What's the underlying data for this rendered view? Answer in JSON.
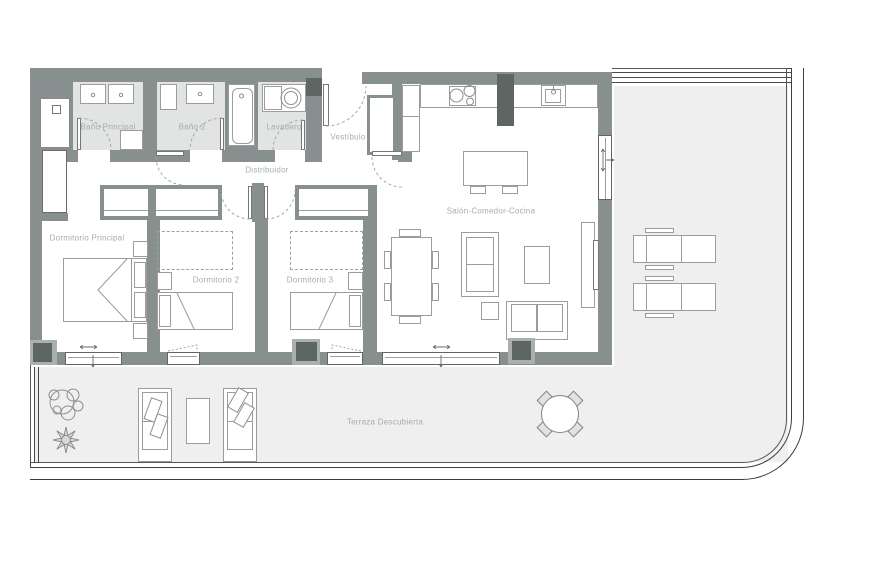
{
  "floor_plan": {
    "labels": {
      "bano_principal": "Baño Principal",
      "bano_2": "Baño 2",
      "lavadero": "Lavadero",
      "vestibulo": "Vestíbulo",
      "distribuidor": "Distribuidor",
      "dormitorio_principal": "Dormitorio Principal",
      "dormitorio_2": "Dormitorio 2",
      "dormitorio_3": "Dormitorio 3",
      "salon_comedor_cocina": "Salón-Comedor-Cocina",
      "terraza_descubierta": "Terraza Descubierta"
    },
    "colors": {
      "wall": "#87908e",
      "column": "#5e6663",
      "wet_room_floor": "#e2e4e3",
      "terrace_floor": "#efefef",
      "furniture_line": "#9c9c9c",
      "boundary_line": "#3f3f3f",
      "label_text": "#a4abb3"
    }
  }
}
